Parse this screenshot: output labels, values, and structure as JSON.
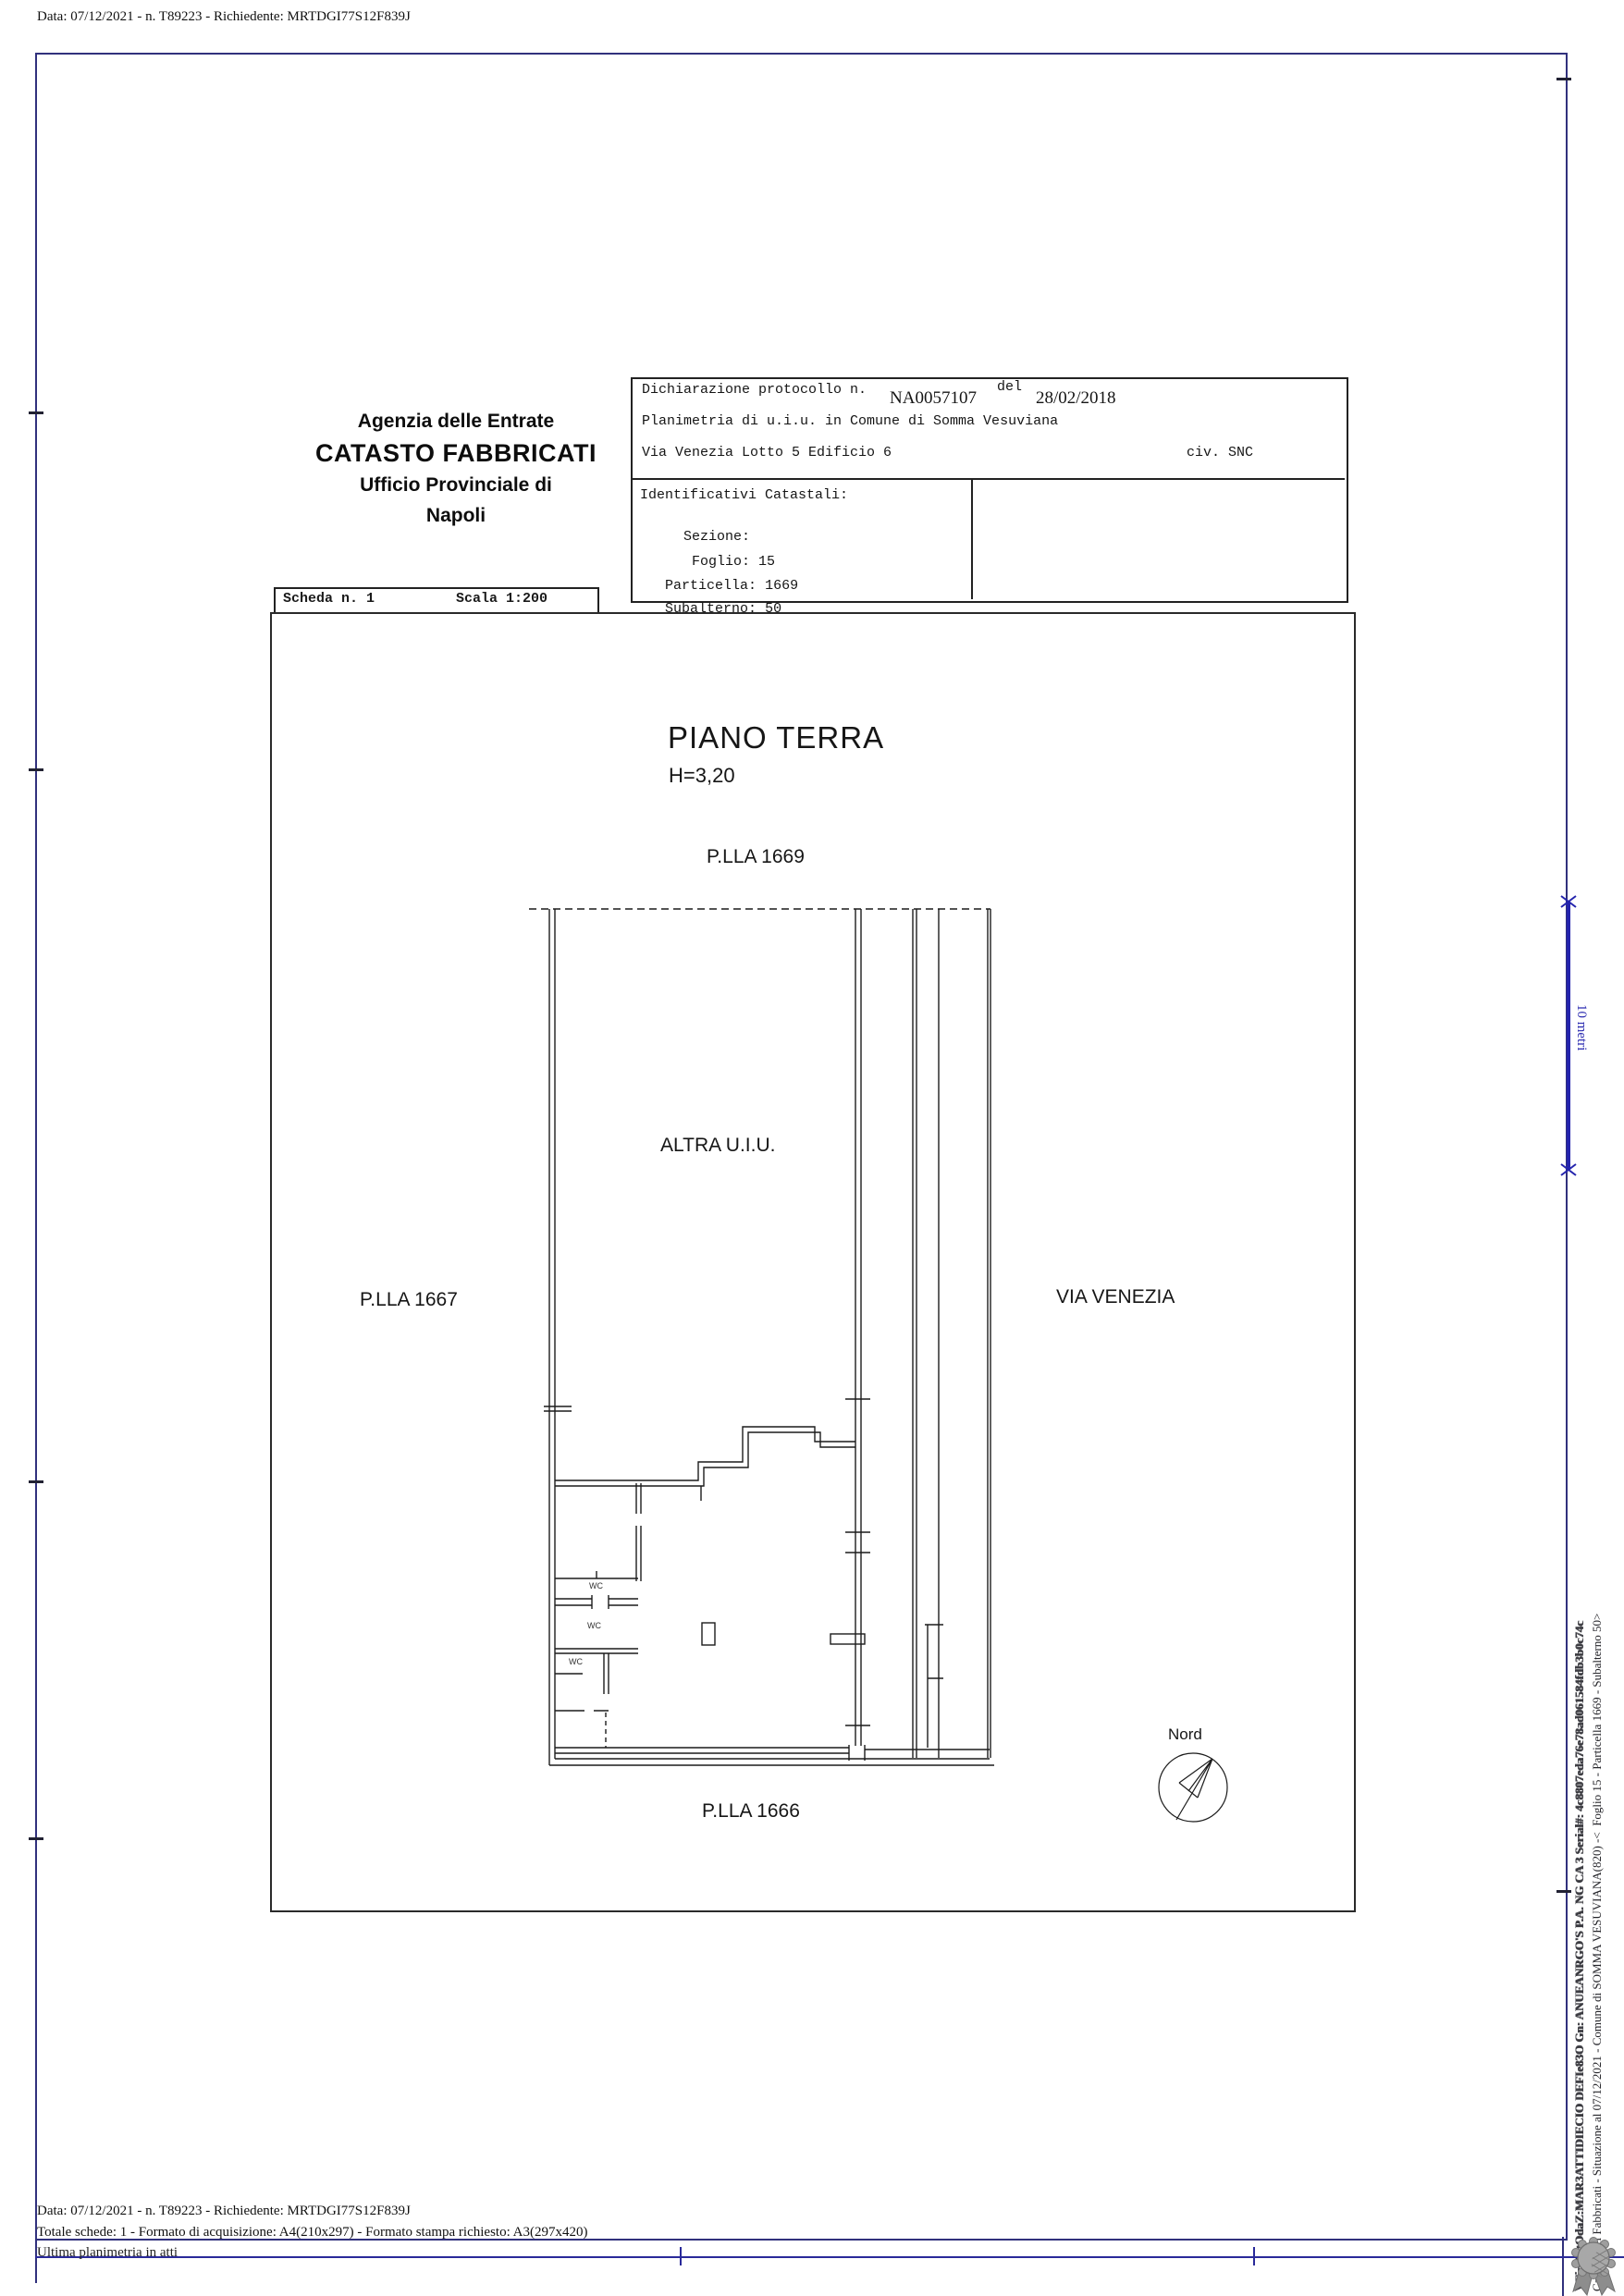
{
  "meta": {
    "top_line": "Data: 07/12/2021 - n. T89223 - Richiedente: MRTDGI77S12F839J",
    "footer_line1": "Data: 07/12/2021 - n. T89223 - Richiedente: MRTDGI77S12F839J",
    "footer_line2": "Totale schede: 1 - Formato di acquisizione: A4(210x297)  - Formato stampa richiesto: A3(297x420)",
    "footer_line3": "Ultima planimetria in atti"
  },
  "agency": {
    "line1": "Agenzia delle Entrate",
    "line2": "CATASTO FABBRICATI",
    "line3": "Ufficio Provinciale di",
    "line4": "Napoli"
  },
  "declaration": {
    "protocol_label": "Dichiarazione protocollo n.",
    "protocol_number": "NA0057107",
    "del_label": "del",
    "protocol_date": "28/02/2018",
    "planimetria_line": "Planimetria di u.i.u. in Comune di Somma Vesuviana",
    "address_line": "Via Venezia Lotto 5 Edificio 6",
    "civic": "civ. SNC"
  },
  "identifiers": {
    "title": "Identificativi Catastali:",
    "sezione_label": "Sezione:",
    "sezione_value": "",
    "foglio_label": "Foglio:",
    "foglio_value": "15",
    "particella_label": "Particella:",
    "particella_value": "1669",
    "subalterno_label": "Subalterno:",
    "subalterno_value": "50"
  },
  "scheda": {
    "number": "Scheda n. 1",
    "scale": "Scala 1:200"
  },
  "plan": {
    "floor_title": "PIANO TERRA",
    "floor_height": "H=3,20",
    "parcel_top": "P.LLA 1669",
    "parcel_left": "P.LLA 1667",
    "parcel_bottom": "P.LLA 1666",
    "street_right": "VIA VENEZIA",
    "other_unit": "ALTRA U.I.U.",
    "north_label": "Nord",
    "wc_labels": [
      "WC",
      "WC",
      "WC"
    ]
  },
  "scalebar": {
    "label": "10 metri"
  },
  "vertical_margin": {
    "line1": "Catasto dei Fabbricati - Situazione al 07/12/2021 - Comune di SOMMA VESUVIANA(820) -<  Foglio 15 - Particella 1669 - Subalterno 50>",
    "line2": "VFirMatOdaZ:MAR3ATTIDIECIO DEFIe83O Gn: ANUEANRGO'S P.A. NG CA 3 Serial#: 4c8807eda76e78ad061584fdb3b0c74c"
  },
  "colors": {
    "page_frame": "#31317d",
    "scalebar_blue": "#2424ad",
    "plan_ink": "#1c1c1c",
    "seal_grey": "#9e9e9e"
  }
}
